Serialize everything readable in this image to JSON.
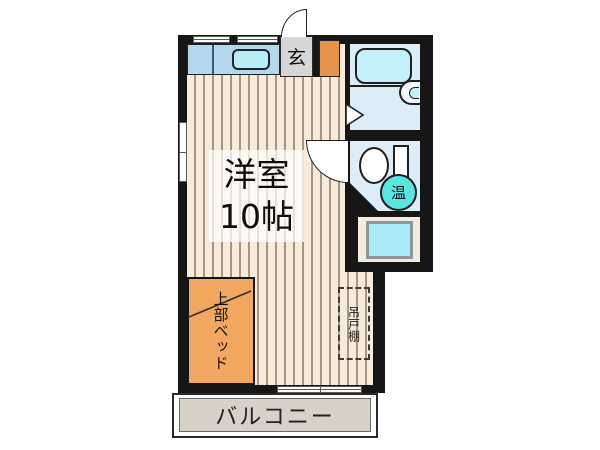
{
  "plan": {
    "type": "apartment-floorplan",
    "room": {
      "name": "洋室",
      "size": "10帖"
    },
    "entrance_label": "玄",
    "loft_bed_label": "上部ベッド",
    "hanging_cupboard_label": "吊戸棚",
    "balcony_label": "バルコニー",
    "water_heater_label": "温"
  },
  "colors": {
    "wall": "#161616",
    "floor_base": "#f9ead9",
    "floor_stripe": "#a2988a",
    "kitchen_counter": "#b3d7ec",
    "sink": "#b9edf6",
    "entrance_floor": "#d6d6d6",
    "shoe_cabinet": "#e5944c",
    "loft_bed": "#f1a75f",
    "bathroom_floor": "#dcecf8",
    "bathtub": "#c3f0fa",
    "water_heater_badge": "#59e5e0",
    "washer_pan": "#a9ecf5",
    "balcony_floor": "#d8d1c8"
  }
}
